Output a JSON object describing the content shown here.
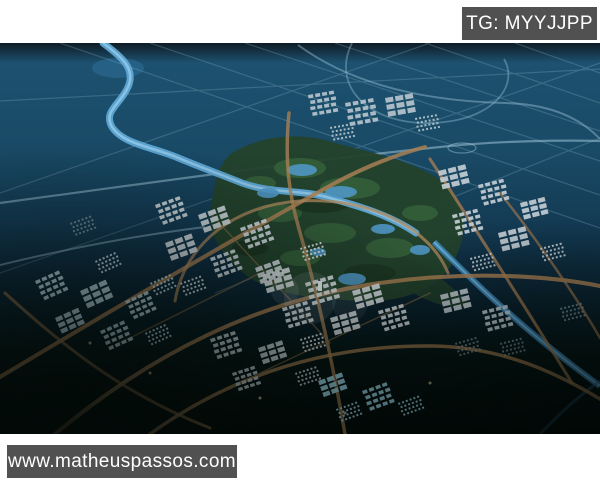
{
  "page": {
    "background_color": "#ffffff"
  },
  "badges": {
    "top_right": {
      "label": "TG: MYYJJPP"
    },
    "bottom_left": {
      "label": "www.matheuspassos.com"
    },
    "background_color": "#515151",
    "text_color": "#ffffff"
  },
  "scene": {
    "alt": "Aerial dusk rendering of a planned city: winding blue river, central wetland park with lakes, clusters of white buildings, tan roads, dark surrounding land",
    "colors": {
      "water": "#1a4a66",
      "river": "#5ea6d4",
      "park_green": "#24422b",
      "roads": "#a87f53",
      "buildings": "#c7d3d9",
      "canal": "#3c83b2",
      "dark_land": "#050f0c"
    }
  }
}
